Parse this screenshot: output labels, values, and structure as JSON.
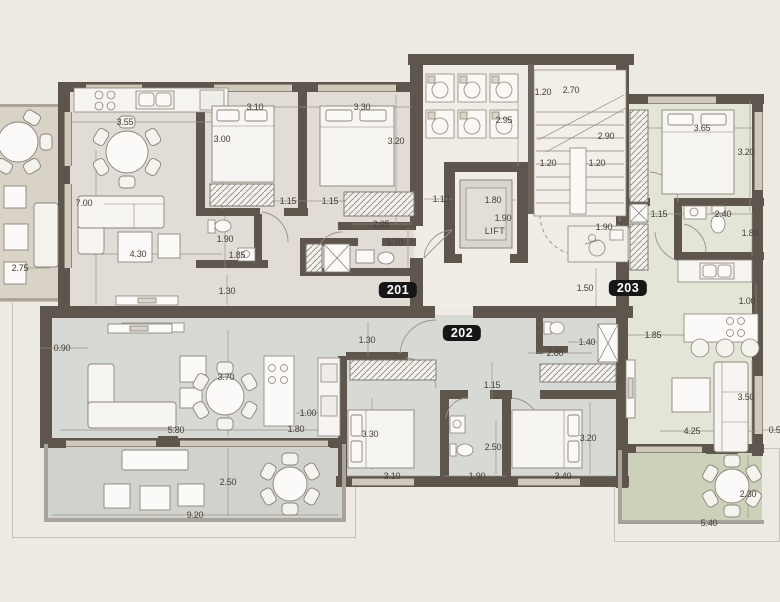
{
  "plan": {
    "lift_label": "LIFT",
    "units": [
      {
        "id": "201",
        "x": 398,
        "y": 290
      },
      {
        "id": "202",
        "x": 462,
        "y": 333
      },
      {
        "id": "203",
        "x": 628,
        "y": 288
      }
    ],
    "colors": {
      "bg": "#edeae3",
      "wall": "#5e564c",
      "floor201": "#e1ddd6",
      "floor202": "#d7d9d5",
      "floor203": "#e3e5d7",
      "bal201": "#d8d2c7",
      "bal202": "#cfd2cd",
      "bal203": "#ccd1ba",
      "dim_text": "#474137",
      "badge_bg": "#161616",
      "badge_text": "#ffffff"
    },
    "dimensions": [
      {
        "t": "3.55",
        "x": 125,
        "y": 122
      },
      {
        "t": "3.10",
        "x": 255,
        "y": 107
      },
      {
        "t": "3.30",
        "x": 362,
        "y": 107
      },
      {
        "t": "3.00",
        "x": 222,
        "y": 139
      },
      {
        "t": "3.20",
        "x": 396,
        "y": 141
      },
      {
        "t": "7.00",
        "x": 84,
        "y": 203
      },
      {
        "t": "1.15",
        "x": 288,
        "y": 201
      },
      {
        "t": "1.15",
        "x": 330,
        "y": 201
      },
      {
        "t": "2.05",
        "x": 381,
        "y": 224
      },
      {
        "t": "1.70",
        "x": 395,
        "y": 242
      },
      {
        "t": "1.90",
        "x": 225,
        "y": 239
      },
      {
        "t": "1.85",
        "x": 237,
        "y": 255
      },
      {
        "t": "4.30",
        "x": 138,
        "y": 254
      },
      {
        "t": "2.75",
        "x": 20,
        "y": 268
      },
      {
        "t": "1.30",
        "x": 227,
        "y": 291
      },
      {
        "t": "1.10",
        "x": 441,
        "y": 199
      },
      {
        "t": "1.20",
        "x": 543,
        "y": 92
      },
      {
        "t": "2.70",
        "x": 571,
        "y": 90
      },
      {
        "t": "2.95",
        "x": 504,
        "y": 120
      },
      {
        "t": "2.90",
        "x": 606,
        "y": 136
      },
      {
        "t": "1.20",
        "x": 548,
        "y": 163
      },
      {
        "t": "1.20",
        "x": 597,
        "y": 163
      },
      {
        "t": "1.80",
        "x": 493,
        "y": 200
      },
      {
        "t": "1.90",
        "x": 503,
        "y": 218
      },
      {
        "t": "1.90",
        "x": 604,
        "y": 227
      },
      {
        "t": "1.50",
        "x": 585,
        "y": 288
      },
      {
        "t": "3.65",
        "x": 702,
        "y": 128
      },
      {
        "t": "3.20",
        "x": 746,
        "y": 152
      },
      {
        "t": "1.15",
        "x": 659,
        "y": 214
      },
      {
        "t": "2.40",
        "x": 723,
        "y": 214
      },
      {
        "t": "1.80",
        "x": 750,
        "y": 233
      },
      {
        "t": "1.00",
        "x": 747,
        "y": 301
      },
      {
        "t": "1.85",
        "x": 653,
        "y": 335
      },
      {
        "t": "3.50",
        "x": 746,
        "y": 397
      },
      {
        "t": "4.25",
        "x": 692,
        "y": 431
      },
      {
        "t": "0.50",
        "x": 777,
        "y": 430
      },
      {
        "t": "2.30",
        "x": 748,
        "y": 494
      },
      {
        "t": "5.40",
        "x": 709,
        "y": 523
      },
      {
        "t": "0.90",
        "x": 62,
        "y": 348
      },
      {
        "t": "1.30",
        "x": 367,
        "y": 340
      },
      {
        "t": "2.80",
        "x": 555,
        "y": 353
      },
      {
        "t": "1.40",
        "x": 587,
        "y": 342
      },
      {
        "t": "3.70",
        "x": 226,
        "y": 377
      },
      {
        "t": "1.15",
        "x": 492,
        "y": 385
      },
      {
        "t": "1.00",
        "x": 308,
        "y": 413
      },
      {
        "t": "3.30",
        "x": 370,
        "y": 434
      },
      {
        "t": "5.80",
        "x": 176,
        "y": 430
      },
      {
        "t": "1.80",
        "x": 296,
        "y": 429
      },
      {
        "t": "2.50",
        "x": 493,
        "y": 447
      },
      {
        "t": "3.10",
        "x": 392,
        "y": 476
      },
      {
        "t": "1.90",
        "x": 477,
        "y": 476
      },
      {
        "t": "3.40",
        "x": 563,
        "y": 476
      },
      {
        "t": "3.20",
        "x": 588,
        "y": 438
      },
      {
        "t": "2.50",
        "x": 228,
        "y": 482
      },
      {
        "t": "9.20",
        "x": 195,
        "y": 515
      }
    ]
  }
}
